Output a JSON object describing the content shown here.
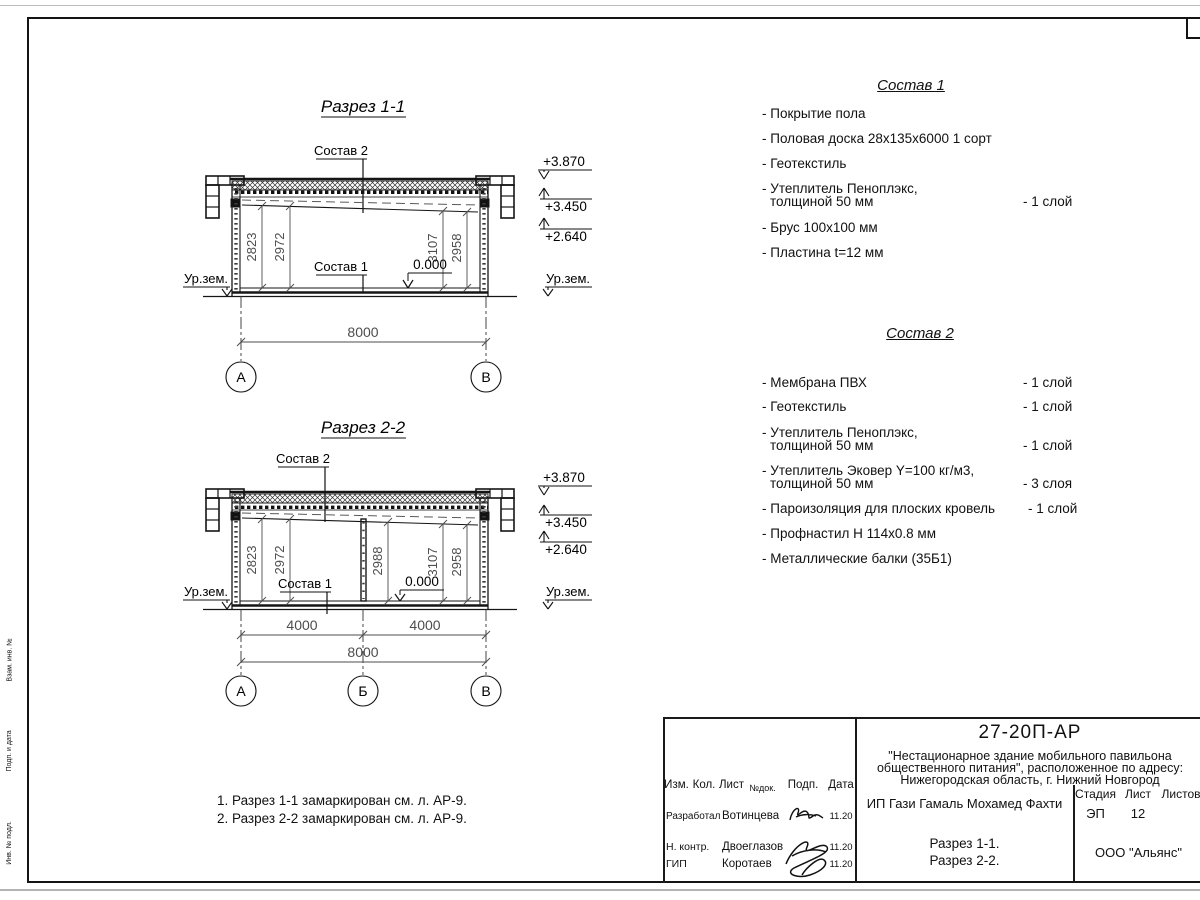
{
  "page": {
    "frame_stamps": [
      "Взам. инв. №",
      "Подп. и дата",
      "Инв. № подл."
    ]
  },
  "section1": {
    "title": "Разрез 1-1",
    "callout_roof": "Состав 2",
    "callout_floor": "Состав 1",
    "zero_mark": "0.000",
    "ground_label": "Ур.зем.",
    "elevations": [
      "+3.870",
      "+3.450",
      "+2.640"
    ],
    "dims": [
      "2823",
      "2972",
      "3107",
      "2958"
    ],
    "dim_total": "8000",
    "axes": [
      "А",
      "В"
    ]
  },
  "section2": {
    "title": "Разрез 2-2",
    "callout_roof": "Состав 2",
    "callout_floor": "Состав 1",
    "zero_mark": "0.000",
    "ground_label": "Ур.зем.",
    "elevations": [
      "+3.870",
      "+3.450",
      "+2.640"
    ],
    "dims": [
      "2823",
      "2972",
      "2988",
      "3107",
      "2958"
    ],
    "dim_spans": [
      "4000",
      "4000"
    ],
    "dim_total": "8000",
    "axes": [
      "А",
      "Б",
      "В"
    ]
  },
  "sostav1": {
    "title": "Состав 1",
    "items": [
      {
        "line1": "- Покрытие пола"
      },
      {
        "line1": "- Половая доска 28х135х6000 1 сорт"
      },
      {
        "line1": "- Геотекстиль"
      },
      {
        "line1": "- Утеплитель Пеноплэкс,",
        "line2": "толщиной 50 мм",
        "qty": "- 1 слой"
      },
      {
        "line1": "- Брус 100х100 мм"
      },
      {
        "line1": "- Пластина t=12 мм"
      }
    ]
  },
  "sostav2": {
    "title": "Состав 2",
    "items": [
      {
        "line1": "- Мембрана ПВХ",
        "qty": "- 1 слой"
      },
      {
        "line1": "- Геотекстиль",
        "qty": "- 1 слой"
      },
      {
        "line1": "- Утеплитель Пеноплэкс,",
        "line2": "толщиной 50 мм",
        "qty": "- 1 слой"
      },
      {
        "line1": "- Утеплитель Эковер Y=100 кг/м3,",
        "line2": "толщиной 50 мм",
        "qty": "- 3 слоя"
      },
      {
        "line1": "- Пароизоляция для плоских кровель",
        "qty": "- 1 слой"
      },
      {
        "line1": "- Профнастил Н 114х0.8 мм"
      },
      {
        "line1": "- Металлические балки (35Б1)"
      }
    ]
  },
  "notes": {
    "line1": "1. Разрез 1-1 замаркирован см. л. АР-9.",
    "line2": "2. Разрез 2-2 замаркирован см. л. АР-9."
  },
  "titleblock": {
    "doc_number": "27-20П-АР",
    "project_line1": "\"Нестационарное здание мобильного павильона",
    "project_line2": "общественного питания\", расположенное по адресу:",
    "project_line3": "Нижегородская область, г. Нижний Новгород",
    "client": "ИП Гази Гамаль Мохамед Фахти",
    "stage_label": "Стадия",
    "sheet_label": "Лист",
    "sheets_label": "Листов",
    "stage_value": "ЭП",
    "sheet_value": "12",
    "drawing_title_line1": "Разрез 1-1.",
    "drawing_title_line2": "Разрез 2-2.",
    "company": "ООО \"Альянс\"",
    "columns": [
      "Изм.",
      "Кол.",
      "Лист",
      "№док.",
      "Подп.",
      "Дата"
    ],
    "rows": [
      {
        "role": "Разработал",
        "name": "Вотинцева",
        "date": "11.20"
      },
      {
        "role": "Н. контр.",
        "name": "Двоеглазов",
        "date": "11.20"
      },
      {
        "role": "ГИП",
        "name": "Коротаев",
        "date": "11.20"
      }
    ]
  }
}
